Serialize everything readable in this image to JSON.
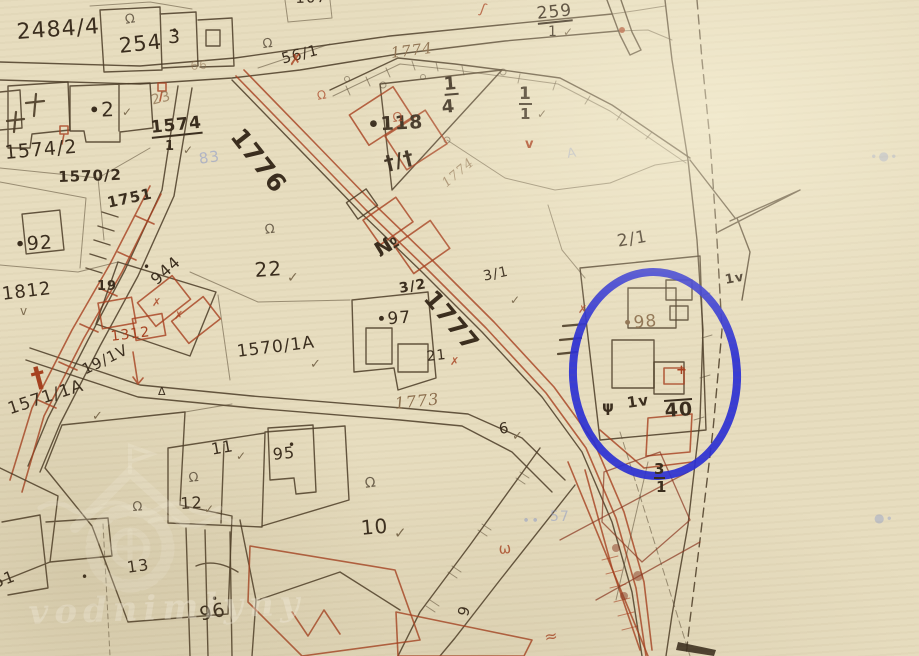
{
  "map": {
    "type": "historical-cadastral-map-scan",
    "watermark_text": "vodnimlyny",
    "annotation": {
      "shape": "ellipse",
      "color": "#2b2fd4",
      "cx": 655,
      "cy": 374,
      "rx": 82,
      "ry": 102,
      "rotate": -3,
      "stroke_width": 8,
      "highlighted_parcels": [
        "98",
        "40"
      ]
    },
    "colors": {
      "paper": "#e7ddbf",
      "ink": "#3a2d1e",
      "ink_line": "#4a3b26",
      "ink_line2": "#5a4a34",
      "red": "#a8401f",
      "red_dark": "#8a3520",
      "brown": "#8c6f4e",
      "gray": "#7d6c50",
      "bluf": "#8898cc",
      "wm": "rgba(255,250,235,0.42)"
    },
    "labels": [
      {
        "t": "2484/4",
        "x": 16,
        "y": 22,
        "s": 22,
        "r": -4,
        "c": "ink"
      },
      {
        "t": "253/2",
        "x": 103,
        "y": -12,
        "s": 15,
        "r": -4,
        "c": "ink"
      },
      {
        "t": "254",
        "x": 118,
        "y": 36,
        "s": 21,
        "r": -6,
        "c": "ink"
      },
      {
        "t": "3",
        "x": 168,
        "y": 28,
        "s": 19,
        "r": 0,
        "c": "ink"
      },
      {
        "t": "•",
        "x": 171,
        "y": 25,
        "s": 12,
        "r": 0,
        "c": "ink"
      },
      {
        "t": "107",
        "x": 295,
        "y": -9,
        "s": 15,
        "r": -2,
        "c": "ink"
      },
      {
        "t": "259",
        "x": 536,
        "y": 6,
        "s": 17,
        "r": -6,
        "c": "ink",
        "u": 1
      },
      {
        "t": "1",
        "x": 548,
        "y": 25,
        "s": 14,
        "r": 0,
        "c": "ink"
      },
      {
        "t": "✓",
        "x": 563,
        "y": 26,
        "s": 12,
        "r": 0,
        "c": "gray"
      },
      {
        "t": "56/1",
        "x": 280,
        "y": 52,
        "s": 15,
        "r": -14,
        "c": "ink"
      },
      {
        "t": "✗",
        "x": 289,
        "y": 52,
        "s": 16,
        "r": 0,
        "c": "red",
        "op": 0.8
      },
      {
        "t": "66",
        "x": 190,
        "y": 60,
        "s": 12,
        "r": -5,
        "c": "brown",
        "op": 0.5
      },
      {
        "t": "1774",
        "x": 390,
        "y": 46,
        "s": 15,
        "r": -7,
        "c": "brown",
        "i": 1
      },
      {
        "t": "1774",
        "x": 440,
        "y": 180,
        "s": 13,
        "r": -40,
        "c": "brown",
        "i": 1,
        "op": 0.7
      },
      {
        "t": "1",
        "x": 443,
        "y": 76,
        "s": 18,
        "r": -5,
        "c": "ink",
        "b": 1,
        "u": 1
      },
      {
        "t": "4",
        "x": 441,
        "y": 99,
        "s": 18,
        "r": -5,
        "c": "ink",
        "b": 1
      },
      {
        "t": "1",
        "x": 519,
        "y": 86,
        "s": 17,
        "r": 0,
        "c": "ink",
        "b": 1,
        "u": 1
      },
      {
        "t": "1",
        "x": 520,
        "y": 107,
        "s": 15,
        "r": 0,
        "c": "ink",
        "b": 1
      },
      {
        "t": "✓",
        "x": 537,
        "y": 108,
        "s": 12,
        "r": 0,
        "c": "gray"
      },
      {
        "t": "v",
        "x": 525,
        "y": 138,
        "s": 13,
        "r": 0,
        "c": "red",
        "b": 1
      },
      {
        "t": "•118",
        "x": 367,
        "y": 116,
        "s": 19,
        "r": -3,
        "c": "ink",
        "b": 1
      },
      {
        "t": "1776",
        "x": 246,
        "y": 124,
        "s": 25,
        "r": 52,
        "c": "ink",
        "b": 1
      },
      {
        "t": "†/†",
        "x": 382,
        "y": 154,
        "s": 20,
        "r": -14,
        "c": "ink",
        "b": 1
      },
      {
        "t": "1574",
        "x": 150,
        "y": 120,
        "s": 17,
        "r": -6,
        "c": "ink",
        "b": 1,
        "u": 1
      },
      {
        "t": "1",
        "x": 165,
        "y": 140,
        "s": 13,
        "r": 0,
        "c": "ink",
        "b": 1
      },
      {
        "t": "✓",
        "x": 183,
        "y": 144,
        "s": 12,
        "r": 0,
        "c": "gray"
      },
      {
        "t": "1574/2",
        "x": 4,
        "y": 144,
        "s": 19,
        "r": -5,
        "c": "ink"
      },
      {
        "t": "1570/2",
        "x": 58,
        "y": 170,
        "s": 15,
        "r": -2,
        "c": "ink",
        "b": 1
      },
      {
        "t": "83",
        "x": 198,
        "y": 152,
        "s": 15,
        "r": -8,
        "c": "bluf",
        "op": 0.55
      },
      {
        "t": "1751",
        "x": 106,
        "y": 196,
        "s": 15,
        "r": -12,
        "c": "ink",
        "b": 1
      },
      {
        "t": "23",
        "x": 150,
        "y": 94,
        "s": 14,
        "r": -14,
        "c": "brown",
        "op": 0.75
      },
      {
        "t": "•2",
        "x": 88,
        "y": 100,
        "s": 20,
        "r": -2,
        "c": "ink"
      },
      {
        "t": "✓",
        "x": 122,
        "y": 106,
        "s": 12,
        "r": 0,
        "c": "gray"
      },
      {
        "t": "•92",
        "x": 14,
        "y": 236,
        "s": 19,
        "r": -4,
        "c": "ink"
      },
      {
        "t": "19",
        "x": 97,
        "y": 280,
        "s": 13,
        "r": 0,
        "c": "ink",
        "b": 1
      },
      {
        "t": "Ω",
        "x": 124,
        "y": 14,
        "s": 13,
        "r": -10,
        "c": "ink",
        "op": 0.7
      },
      {
        "t": "Ω",
        "x": 262,
        "y": 38,
        "s": 13,
        "r": -6,
        "c": "ink",
        "op": 0.7
      },
      {
        "t": "Ω",
        "x": 264,
        "y": 224,
        "s": 13,
        "r": -8,
        "c": "ink",
        "op": 0.7
      },
      {
        "t": "22",
        "x": 254,
        "y": 260,
        "s": 20,
        "r": -4,
        "c": "ink"
      },
      {
        "t": "✓",
        "x": 287,
        "y": 271,
        "s": 14,
        "r": 0,
        "c": "gray"
      },
      {
        "t": "944",
        "x": 148,
        "y": 276,
        "s": 16,
        "r": -42,
        "c": "ink"
      },
      {
        "t": "•",
        "x": 143,
        "y": 261,
        "s": 12,
        "r": 0,
        "c": "ink"
      },
      {
        "t": "1812",
        "x": 1,
        "y": 286,
        "s": 18,
        "r": -7,
        "c": "ink"
      },
      {
        "t": "v",
        "x": 20,
        "y": 305,
        "s": 12,
        "r": 0,
        "c": "gray"
      },
      {
        "t": "1312",
        "x": 110,
        "y": 330,
        "s": 14,
        "r": -7,
        "c": "red"
      },
      {
        "t": "✗",
        "x": 152,
        "y": 297,
        "s": 11,
        "r": 0,
        "c": "red",
        "op": 0.8
      },
      {
        "t": "✗",
        "x": 174,
        "y": 310,
        "s": 11,
        "r": 0,
        "c": "red",
        "op": 0.8
      },
      {
        "t": "№",
        "x": 371,
        "y": 243,
        "s": 20,
        "r": -32,
        "c": "ink",
        "b": 1
      },
      {
        "t": "3/2",
        "x": 398,
        "y": 282,
        "s": 14,
        "r": -10,
        "c": "ink",
        "b": 1
      },
      {
        "t": "1777",
        "x": 438,
        "y": 286,
        "s": 24,
        "r": 50,
        "c": "ink",
        "b": 1
      },
      {
        "t": "3/1",
        "x": 482,
        "y": 270,
        "s": 14,
        "r": -12,
        "c": "ink"
      },
      {
        "t": "✓",
        "x": 510,
        "y": 294,
        "s": 12,
        "r": 0,
        "c": "gray"
      },
      {
        "t": "•97",
        "x": 376,
        "y": 312,
        "s": 17,
        "r": -4,
        "c": "ink"
      },
      {
        "t": "21",
        "x": 426,
        "y": 350,
        "s": 14,
        "r": -6,
        "c": "ink"
      },
      {
        "t": "✗",
        "x": 450,
        "y": 356,
        "s": 11,
        "r": 0,
        "c": "red",
        "op": 0.8
      },
      {
        "t": "1570/1A",
        "x": 236,
        "y": 344,
        "s": 17,
        "r": -7,
        "c": "ink"
      },
      {
        "t": "✓",
        "x": 310,
        "y": 358,
        "s": 13,
        "r": 0,
        "c": "gray"
      },
      {
        "t": "1773",
        "x": 394,
        "y": 396,
        "s": 16,
        "r": -6,
        "c": "brown",
        "i": 1
      },
      {
        "t": "19/1V",
        "x": 80,
        "y": 364,
        "s": 15,
        "r": -26,
        "c": "ink"
      },
      {
        "t": "Δ",
        "x": 158,
        "y": 386,
        "s": 11,
        "r": 0,
        "c": "ink"
      },
      {
        "t": "1571/1A",
        "x": 6,
        "y": 402,
        "s": 17,
        "r": -18,
        "c": "ink"
      },
      {
        "t": "✓",
        "x": 92,
        "y": 410,
        "s": 13,
        "r": 0,
        "c": "gray"
      },
      {
        "t": "†",
        "x": 28,
        "y": 366,
        "s": 28,
        "r": -15,
        "c": "red",
        "b": 1
      },
      {
        "t": "2/1",
        "x": 616,
        "y": 234,
        "s": 17,
        "r": -10,
        "c": "ink"
      },
      {
        "t": "•98",
        "x": 622,
        "y": 316,
        "s": 17,
        "r": -5,
        "c": "brown"
      },
      {
        "t": "1v",
        "x": 724,
        "y": 274,
        "s": 13,
        "r": -10,
        "c": "ink",
        "b": 1
      },
      {
        "t": "ψ",
        "x": 602,
        "y": 400,
        "s": 15,
        "r": 0,
        "c": "ink",
        "b": 1
      },
      {
        "t": "1v",
        "x": 626,
        "y": 396,
        "s": 15,
        "r": -8,
        "c": "ink",
        "b": 1
      },
      {
        "t": "40",
        "x": 664,
        "y": 400,
        "s": 19,
        "r": -4,
        "c": "ink",
        "b": 1,
        "o": 1
      },
      {
        "t": "3",
        "x": 654,
        "y": 462,
        "s": 15,
        "r": 0,
        "c": "ink",
        "b": 1,
        "u": 1
      },
      {
        "t": "1",
        "x": 656,
        "y": 480,
        "s": 15,
        "r": 0,
        "c": "ink",
        "b": 1
      },
      {
        "t": "+",
        "x": 676,
        "y": 364,
        "s": 13,
        "r": 0,
        "c": "red",
        "b": 1
      },
      {
        "t": "✗",
        "x": 578,
        "y": 304,
        "s": 11,
        "r": 0,
        "c": "red",
        "op": 0.8
      },
      {
        "t": "11",
        "x": 210,
        "y": 442,
        "s": 16,
        "r": -10,
        "c": "ink"
      },
      {
        "t": "✓",
        "x": 236,
        "y": 450,
        "s": 12,
        "r": 0,
        "c": "gray"
      },
      {
        "t": "12",
        "x": 180,
        "y": 496,
        "s": 16,
        "r": -3,
        "c": "ink"
      },
      {
        "t": "✓",
        "x": 204,
        "y": 503,
        "s": 12,
        "r": 0,
        "c": "gray"
      },
      {
        "t": "13",
        "x": 126,
        "y": 560,
        "s": 16,
        "r": -8,
        "c": "ink"
      },
      {
        "t": "96",
        "x": 198,
        "y": 606,
        "s": 19,
        "r": -12,
        "c": "ink"
      },
      {
        "t": "•",
        "x": 211,
        "y": 593,
        "s": 12,
        "r": 0,
        "c": "ink"
      },
      {
        "t": "95",
        "x": 272,
        "y": 447,
        "s": 16,
        "r": -6,
        "c": "ink"
      },
      {
        "t": "•",
        "x": 288,
        "y": 439,
        "s": 12,
        "r": 0,
        "c": "ink"
      },
      {
        "t": "•",
        "x": 81,
        "y": 571,
        "s": 12,
        "r": 0,
        "c": "ink"
      },
      {
        "t": "10",
        "x": 360,
        "y": 518,
        "s": 20,
        "r": -5,
        "c": "ink"
      },
      {
        "t": "✓",
        "x": 394,
        "y": 526,
        "s": 15,
        "r": 0,
        "c": "gray"
      },
      {
        "t": "6",
        "x": 498,
        "y": 422,
        "s": 15,
        "r": -8,
        "c": "ink"
      },
      {
        "t": "✓",
        "x": 512,
        "y": 430,
        "s": 13,
        "r": 0,
        "c": "gray"
      },
      {
        "t": "9",
        "x": 456,
        "y": 614,
        "s": 15,
        "r": -75,
        "c": "ink"
      },
      {
        "t": "51",
        "x": -9,
        "y": 576,
        "s": 16,
        "r": -20,
        "c": "ink"
      },
      {
        "t": "Ω",
        "x": 188,
        "y": 472,
        "s": 13,
        "r": -6,
        "c": "ink",
        "op": 0.7
      },
      {
        "t": "Ω",
        "x": 132,
        "y": 501,
        "s": 13,
        "r": -4,
        "c": "ink",
        "op": 0.7
      },
      {
        "t": "Ω",
        "x": 364,
        "y": 477,
        "s": 14,
        "r": -8,
        "c": "ink",
        "op": 0.7
      },
      {
        "t": "Ω",
        "x": 392,
        "y": 112,
        "s": 13,
        "r": -6,
        "c": "red",
        "op": 0.75
      },
      {
        "t": "Ω",
        "x": 316,
        "y": 90,
        "s": 12,
        "r": -10,
        "c": "red",
        "op": 0.7
      },
      {
        "t": "ʃ",
        "x": 483,
        "y": 2,
        "s": 14,
        "r": 20,
        "c": "red",
        "op": 0.8
      },
      {
        "t": "ω",
        "x": 498,
        "y": 542,
        "s": 15,
        "r": -5,
        "c": "red",
        "op": 0.8
      },
      {
        "t": "≈",
        "x": 543,
        "y": 630,
        "s": 16,
        "r": -10,
        "c": "red",
        "op": 0.8
      },
      {
        "t": "57",
        "x": 550,
        "y": 510,
        "s": 14,
        "r": 0,
        "c": "bluf",
        "op": 0.5
      },
      {
        "t": "∙∙",
        "x": 522,
        "y": 514,
        "s": 13,
        "r": 0,
        "c": "bluf",
        "op": 0.5
      },
      {
        "t": "A",
        "x": 566,
        "y": 148,
        "s": 13,
        "r": -10,
        "c": "bluf",
        "op": 0.45
      },
      {
        "t": "∙●∙",
        "x": 870,
        "y": 150,
        "s": 12,
        "r": 0,
        "c": "bluf",
        "op": 0.4
      },
      {
        "t": "●∙",
        "x": 874,
        "y": 512,
        "s": 12,
        "r": 0,
        "c": "bluf",
        "op": 0.4
      }
    ]
  }
}
